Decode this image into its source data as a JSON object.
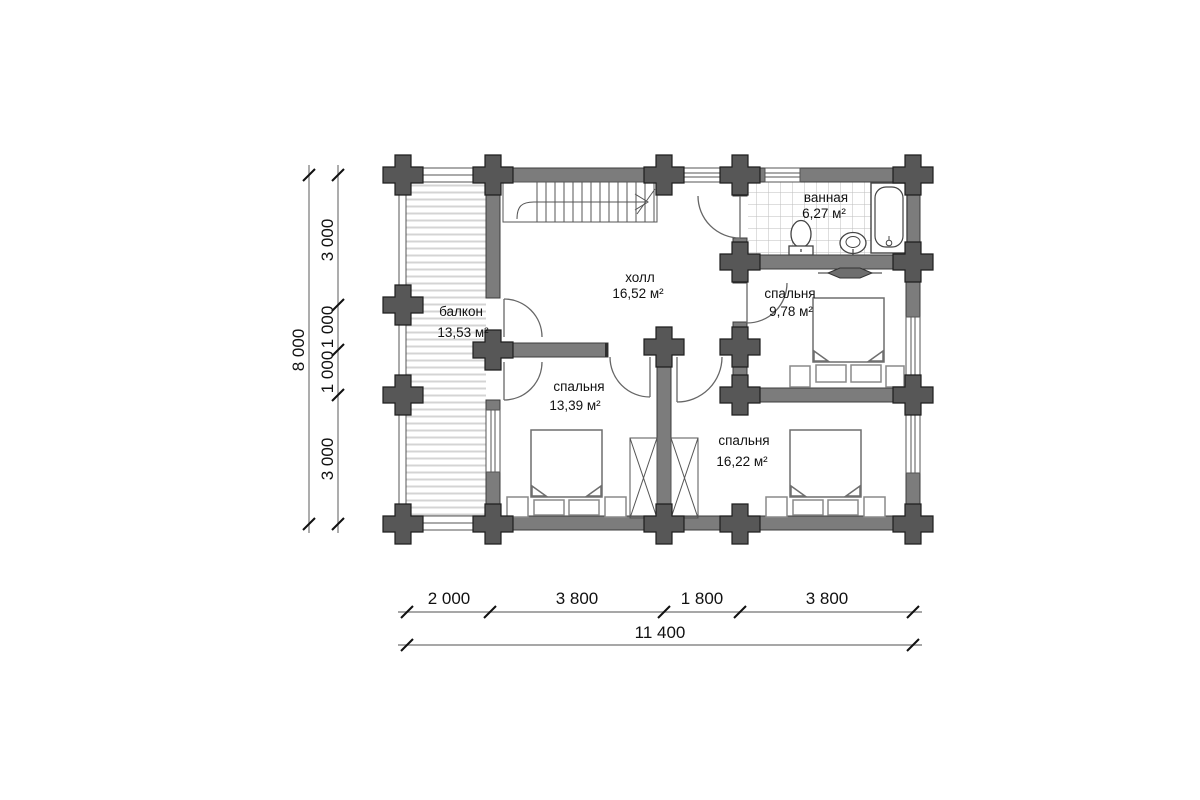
{
  "rooms": {
    "balcony": {
      "name": "балкон",
      "area": "13,53 м²"
    },
    "hall": {
      "name": "холл",
      "area": "16,52 м²"
    },
    "bathroom": {
      "name": "ванная",
      "area": "6,27 м²"
    },
    "bedroom_right": {
      "name": "спальня",
      "area": "9,78 м²"
    },
    "bedroom_left": {
      "name": "спальня",
      "area": "13,39 м²"
    },
    "bedroom_bottom": {
      "name": "спальня",
      "area": "16,22 м²"
    }
  },
  "dimensions": {
    "vertical": {
      "total": "8 000",
      "segments": [
        "3 000",
        "1 000",
        "1 000",
        "3 000"
      ]
    },
    "horizontal": {
      "total": "11 400",
      "segments": [
        "2 000",
        "3 800",
        "1 800",
        "3 800"
      ]
    }
  },
  "colors": {
    "background": "#ffffff",
    "wall": "#7c7c7c",
    "log_end": "#575757",
    "deck_hatch": "#d4d4d4",
    "tile_grid": "#bdbdbd",
    "furniture_outline": "#8a8a8a",
    "dimension_line": "#8a8a8a",
    "text": "#111111"
  }
}
